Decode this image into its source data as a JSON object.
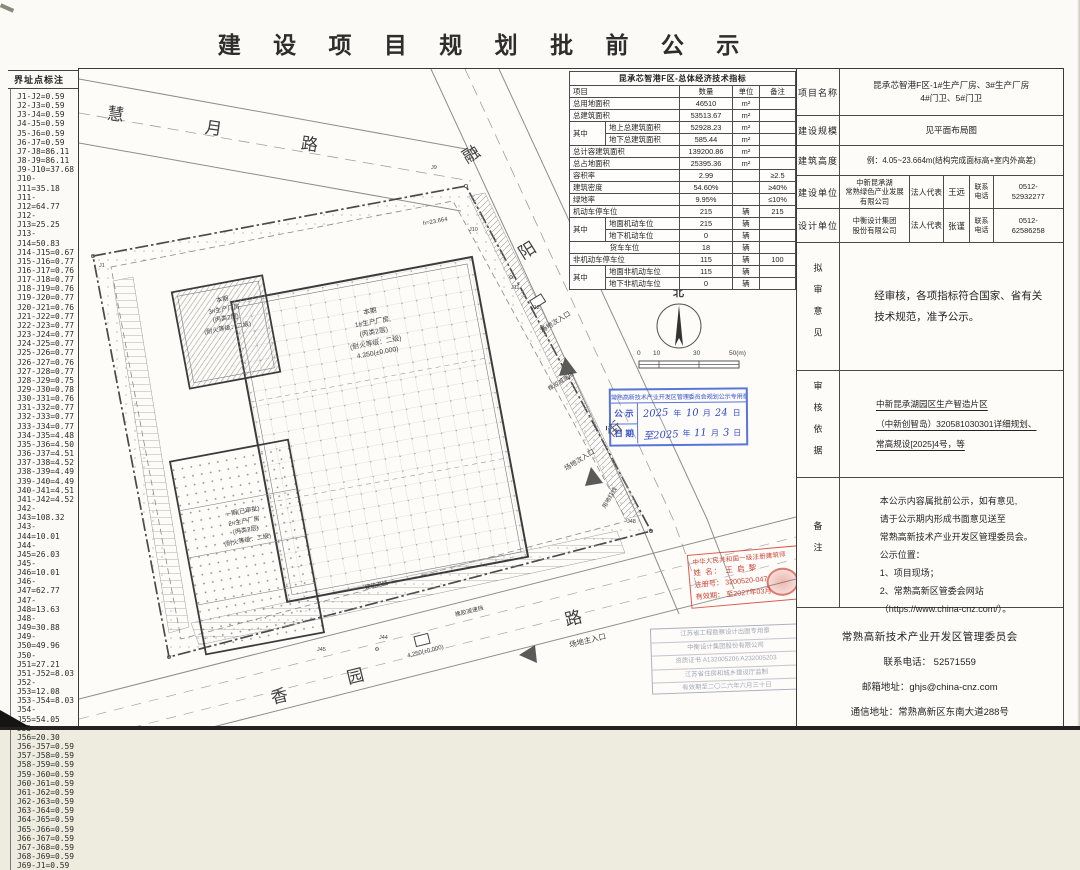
{
  "title": "建 设 项 目 规 划 批 前 公 示",
  "boundary": {
    "header": "界址点标注",
    "lines": [
      "J1-J2=0.59",
      "J2-J3=0.59",
      "J3-J4=0.59",
      "J4-J5=0.59",
      "J5-J6=0.59",
      "J6-J7=0.59",
      "J7-J8=86.11",
      "J8-J9=86.11",
      "J9-J10=37.68",
      "J10-J11=35.18",
      "J11-J12=64.77",
      "J12-J13=25.25",
      "J13-J14=50.83",
      "J14-J15=0.67",
      "J15-J16=0.77",
      "J16-J17=0.76",
      "J17-J18=0.77",
      "J18-J19=0.76",
      "J19-J20=0.77",
      "J20-J21=0.76",
      "J21-J22=0.77",
      "J22-J23=0.77",
      "J23-J24=0.77",
      "J24-J25=0.77",
      "J25-J26=0.77",
      "J26-J27=0.76",
      "J27-J28=0.77",
      "J28-J29=0.75",
      "J29-J30=0.78",
      "J30-J31=0.76",
      "J31-J32=0.77",
      "J32-J33=0.77",
      "J33-J34=0.77",
      "J34-J35=4.48",
      "J35-J36=4.50",
      "J36-J37=4.51",
      "J37-J38=4.52",
      "J38-J39=4.49",
      "J39-J40=4.49",
      "J40-J41=4.51",
      "J41-J42=4.52",
      "J42-J43=108.32",
      "J43-J44=10.01",
      "J44-J45=26.03",
      "J45-J46=10.01",
      "J46-J47=62.77",
      "J47-J48=13.63",
      "J48-J49=30.88",
      "J49-J50=49.96",
      "J50-J51=27.21",
      "J51-J52=8.03",
      "J52-J53=12.08",
      "J53-J54=8.03",
      "J54-J55=54.05",
      "J55-J56=20.30",
      "J56-J57=0.59",
      "J57-J58=0.59",
      "J58-J59=0.59",
      "J59-J60=0.59",
      "J60-J61=0.59",
      "J61-J62=0.59",
      "J62-J63=0.59",
      "J63-J64=0.59",
      "J64-J65=0.59",
      "J65-J66=0.59",
      "J66-J67=0.59",
      "J67-J68=0.59",
      "J68-J69=0.59",
      "J69-J1=0.59"
    ]
  },
  "eco": {
    "rows": [
      [
        {
          "t": "昆承芯智港F区-总体经济技术指标",
          "cs": 5,
          "cl": "tt"
        }
      ],
      [
        {
          "t": "项目",
          "cs": 2,
          "cl": "l"
        },
        {
          "t": "数量"
        },
        {
          "t": "单位"
        },
        {
          "t": "备注"
        }
      ],
      [
        {
          "t": "总用地面积",
          "cs": 2,
          "cl": "l"
        },
        {
          "t": "46510"
        },
        {
          "t": "m²"
        },
        {
          "t": ""
        }
      ],
      [
        {
          "t": "总建筑面积",
          "cs": 2,
          "cl": "l"
        },
        {
          "t": "53513.67"
        },
        {
          "t": "m²"
        },
        {
          "t": ""
        }
      ],
      [
        {
          "t": "其中",
          "rs": 2,
          "cl": "l"
        },
        {
          "t": "地上总建筑面积",
          "cl": "l"
        },
        {
          "t": "52928.23"
        },
        {
          "t": "m²"
        },
        {
          "t": ""
        }
      ],
      [
        {
          "t": "地下总建筑面积",
          "cl": "l"
        },
        {
          "t": "585.44"
        },
        {
          "t": "m²"
        },
        {
          "t": ""
        }
      ],
      [
        {
          "t": "总计容建筑面积",
          "cs": 2,
          "cl": "l"
        },
        {
          "t": "139200.86"
        },
        {
          "t": "m²"
        },
        {
          "t": ""
        }
      ],
      [
        {
          "t": "总占地面积",
          "cs": 2,
          "cl": "l"
        },
        {
          "t": "25395.36"
        },
        {
          "t": "m²"
        },
        {
          "t": ""
        }
      ],
      [
        {
          "t": "容积率",
          "cs": 2,
          "cl": "l"
        },
        {
          "t": "2.99"
        },
        {
          "t": ""
        },
        {
          "t": "≥2.5"
        }
      ],
      [
        {
          "t": "建筑密度",
          "cs": 2,
          "cl": "l"
        },
        {
          "t": "54.60%"
        },
        {
          "t": ""
        },
        {
          "t": "≥40%"
        }
      ],
      [
        {
          "t": "绿地率",
          "cs": 2,
          "cl": "l"
        },
        {
          "t": "9.95%"
        },
        {
          "t": ""
        },
        {
          "t": "≤10%"
        }
      ],
      [
        {
          "t": "机动车停车位",
          "cs": 2,
          "cl": "l"
        },
        {
          "t": "215"
        },
        {
          "t": "辆"
        },
        {
          "t": "215"
        }
      ],
      [
        {
          "t": "其中",
          "rs": 2,
          "cl": "l"
        },
        {
          "t": "地面机动车位",
          "cl": "l"
        },
        {
          "t": "215"
        },
        {
          "t": "辆"
        },
        {
          "t": ""
        }
      ],
      [
        {
          "t": "地下机动车位",
          "cl": "l"
        },
        {
          "t": "0"
        },
        {
          "t": "辆"
        },
        {
          "t": ""
        }
      ],
      [
        {
          "t": "货车车位",
          "cs": 2,
          "cl": "c"
        },
        {
          "t": "18"
        },
        {
          "t": "辆"
        },
        {
          "t": ""
        }
      ],
      [
        {
          "t": "非机动车停车位",
          "cs": 2,
          "cl": "l"
        },
        {
          "t": "115"
        },
        {
          "t": "辆"
        },
        {
          "t": "100"
        }
      ],
      [
        {
          "t": "其中",
          "rs": 2,
          "cl": "l"
        },
        {
          "t": "地面非机动车位",
          "cl": "l"
        },
        {
          "t": "115"
        },
        {
          "t": "辆"
        },
        {
          "t": ""
        }
      ],
      [
        {
          "t": "地下非机动车位",
          "cl": "l"
        },
        {
          "t": "0"
        },
        {
          "t": "辆"
        },
        {
          "t": ""
        }
      ]
    ]
  },
  "info": {
    "project": {
      "label": "项目名称",
      "value": "昆承芯智港F区-1#生产厂房、3#生产厂房\n4#门卫、5#门卫"
    },
    "scale": {
      "label": "建设规模",
      "value": "见平面布局图"
    },
    "height": {
      "label": "建筑高度",
      "value": "例：4.05~23.664m(结构完成面标高+室内外高差)"
    },
    "owner": {
      "label": "建设单位",
      "company": "中新昆承湖\n常熟绿色产业发展\n有限公司",
      "rep_label": "法人代表",
      "rep": "王远",
      "tel_label": "联系\n电话",
      "tel": "0512-\n52932277"
    },
    "designer": {
      "label": "设计单位",
      "company": "中衡设计集团\n股份有限公司",
      "rep_label": "法人代表",
      "rep": "张谨",
      "tel_label": "联系\n电话",
      "tel": "0512-\n62586258"
    },
    "opinion": {
      "label": "拟审意见",
      "value": "经审核，各项指标符合国家、省有关\n技术规范，准予公示。"
    },
    "basis": {
      "label": "审核依据",
      "value": "中新昆承湖园区生产智造片区\n（中新创智岛）320581030301详细规划、\n常高规设[2025]4号，等"
    },
    "remark": {
      "label": "备注",
      "value": "本公示内容属批前公示，如有意见,\n请于公示期内形成书面意见送至\n常熟高新技术产业开发区管理委员会。\n公示位置：\n1、项目现场；\n2、常熟高新区管委会网站\n（https://www.china-cnz.com/）。"
    }
  },
  "footer": {
    "title": "常熟高新技术产业开发区管理委员会",
    "lines": [
      "联系电话：  52571559",
      "邮箱地址：ghjs@china-cnz.com",
      "通信地址：常熟高新区东南大道288号"
    ]
  },
  "stamps": {
    "blue": {
      "header": "常熟高新技术产业开发区管理委员会规划公示专用章",
      "label1": "公 示",
      "label2": "日 期",
      "row1": [
        "2025",
        "年",
        "10",
        "月",
        "24",
        "日"
      ],
      "row2": [
        "至2025",
        "年",
        "11",
        "月",
        "3",
        "日"
      ]
    },
    "red": {
      "line1": "中华人民共和国一级注册建筑师",
      "line2": "姓 名： 王 启 黎",
      "line3": "注册号： 3200520-047",
      "line4": "有效期： 至2027年03月"
    },
    "faint": {
      "lines": [
        "江苏省工程勘察设计出图专用章",
        "中衡设计集团股份有限公司",
        "资质证书 A132005206 A232005203",
        "江苏省住房和城乡建设厅监制",
        "有效期至二〇二六年六月三十日"
      ]
    }
  },
  "map": {
    "labels": [
      {
        "t": "慧",
        "x": 28,
        "y": 36,
        "s": 17,
        "r": 8,
        "name": "road-name-huiyue-lu"
      },
      {
        "t": "月",
        "x": 126,
        "y": 50,
        "s": 17,
        "r": 8,
        "name": "road-name-huiyue-lu"
      },
      {
        "t": "路",
        "x": 222,
        "y": 66,
        "s": 17,
        "r": 8,
        "name": "road-name-huiyue-lu"
      },
      {
        "t": "融",
        "x": 384,
        "y": 76,
        "s": 17,
        "r": -32,
        "name": "road-name-rongyang-jie"
      },
      {
        "t": "阳",
        "x": 440,
        "y": 172,
        "s": 17,
        "r": -32,
        "name": "road-name-rongyang-jie"
      },
      {
        "t": "街",
        "x": 528,
        "y": 352,
        "s": 15,
        "r": -40,
        "name": "road-name-rongyang-jie"
      },
      {
        "t": "香",
        "x": 192,
        "y": 618,
        "s": 17,
        "r": -14,
        "name": "road-name-xiangyuan-lu"
      },
      {
        "t": "园",
        "x": 268,
        "y": 598,
        "s": 17,
        "r": -14,
        "name": "road-name-xiangyuan-lu"
      },
      {
        "t": "路",
        "x": 486,
        "y": 540,
        "s": 17,
        "r": -14,
        "name": "road-name-xiangyuan-lu"
      },
      {
        "t": "北",
        "x": 594,
        "y": 218,
        "s": 11,
        "cls": "b",
        "name": "north-label"
      },
      {
        "t": "0",
        "x": 558,
        "y": 281,
        "s": 6.5,
        "name": "scale-tick"
      },
      {
        "t": "10",
        "x": 574,
        "y": 281,
        "s": 6.5,
        "name": "scale-tick"
      },
      {
        "t": "30",
        "x": 614,
        "y": 281,
        "s": 6.5,
        "name": "scale-tick"
      },
      {
        "t": "50(m)",
        "x": 650,
        "y": 281,
        "s": 6.5,
        "name": "scale-tick"
      },
      {
        "t": "本期\n1#生产厂房\n(丙类2层)\n(耐火等级：二级)\n4.250(±0.000)",
        "x": 240,
        "y": 238,
        "s": 6.8,
        "r": -10.6,
        "w": 110,
        "lh": 10.5,
        "name": "building-1-label"
      },
      {
        "t": "本期\n3#生产厂房\n(丙类2层)\n(耐火等级：二级)",
        "x": 110,
        "y": 226,
        "s": 6.2,
        "r": -10.6,
        "w": 72,
        "lh": 9.5,
        "name": "building-3-label"
      },
      {
        "t": "一期(已审批)\n2#生产厂房\n(丙类2层)\n(耐火等级：二级)",
        "x": 118,
        "y": 438,
        "s": 6.2,
        "r": -10.6,
        "w": 96,
        "lh": 9.5,
        "name": "building-2-label"
      },
      {
        "t": "h≈23.664",
        "x": 344,
        "y": 150,
        "s": 6,
        "r": -10.6,
        "name": "height-note"
      },
      {
        "t": "场地次入口",
        "x": 460,
        "y": 250,
        "s": 6.8,
        "r": -32,
        "name": "secondary-entrance-label"
      },
      {
        "t": "场地次入口",
        "x": 484,
        "y": 388,
        "s": 6.8,
        "r": -32,
        "name": "secondary-entrance-label"
      },
      {
        "t": "场地主入口",
        "x": 490,
        "y": 568,
        "s": 7.5,
        "r": -14,
        "name": "main-entrance-label"
      },
      {
        "t": "橡胶减速挡",
        "x": 376,
        "y": 540,
        "s": 5.8,
        "r": -14,
        "name": "speed-bump-label"
      },
      {
        "t": "橡胶减速挡",
        "x": 468,
        "y": 310,
        "s": 5.8,
        "r": -32,
        "name": "speed-bump-label"
      },
      {
        "t": "用地红线",
        "x": 520,
        "y": 426,
        "s": 5.8,
        "r": -60,
        "name": "red-line-label"
      },
      {
        "t": "建筑退线",
        "x": 286,
        "y": 514,
        "s": 5.8,
        "r": -12,
        "name": "setback-line-label"
      },
      {
        "t": "4.250(±0.000)",
        "x": 328,
        "y": 580,
        "s": 6,
        "r": -14,
        "name": "elevation-note"
      },
      {
        "t": "J1",
        "x": 20,
        "y": 194,
        "s": 5.5,
        "name": "boundary-point"
      },
      {
        "t": "J9",
        "x": 352,
        "y": 96,
        "s": 5.5,
        "name": "boundary-point"
      },
      {
        "t": "J10",
        "x": 390,
        "y": 158,
        "s": 5.5,
        "name": "boundary-point"
      },
      {
        "t": "J11",
        "x": 432,
        "y": 216,
        "s": 5.5,
        "name": "boundary-point"
      },
      {
        "t": "J12",
        "x": 452,
        "y": 236,
        "s": 5.5,
        "name": "boundary-point"
      },
      {
        "t": "J44",
        "x": 300,
        "y": 566,
        "s": 5.5,
        "name": "boundary-point"
      },
      {
        "t": "J45",
        "x": 238,
        "y": 578,
        "s": 5.5,
        "name": "boundary-point"
      },
      {
        "t": "J48",
        "x": 548,
        "y": 450,
        "s": 5.5,
        "name": "boundary-point"
      }
    ]
  }
}
